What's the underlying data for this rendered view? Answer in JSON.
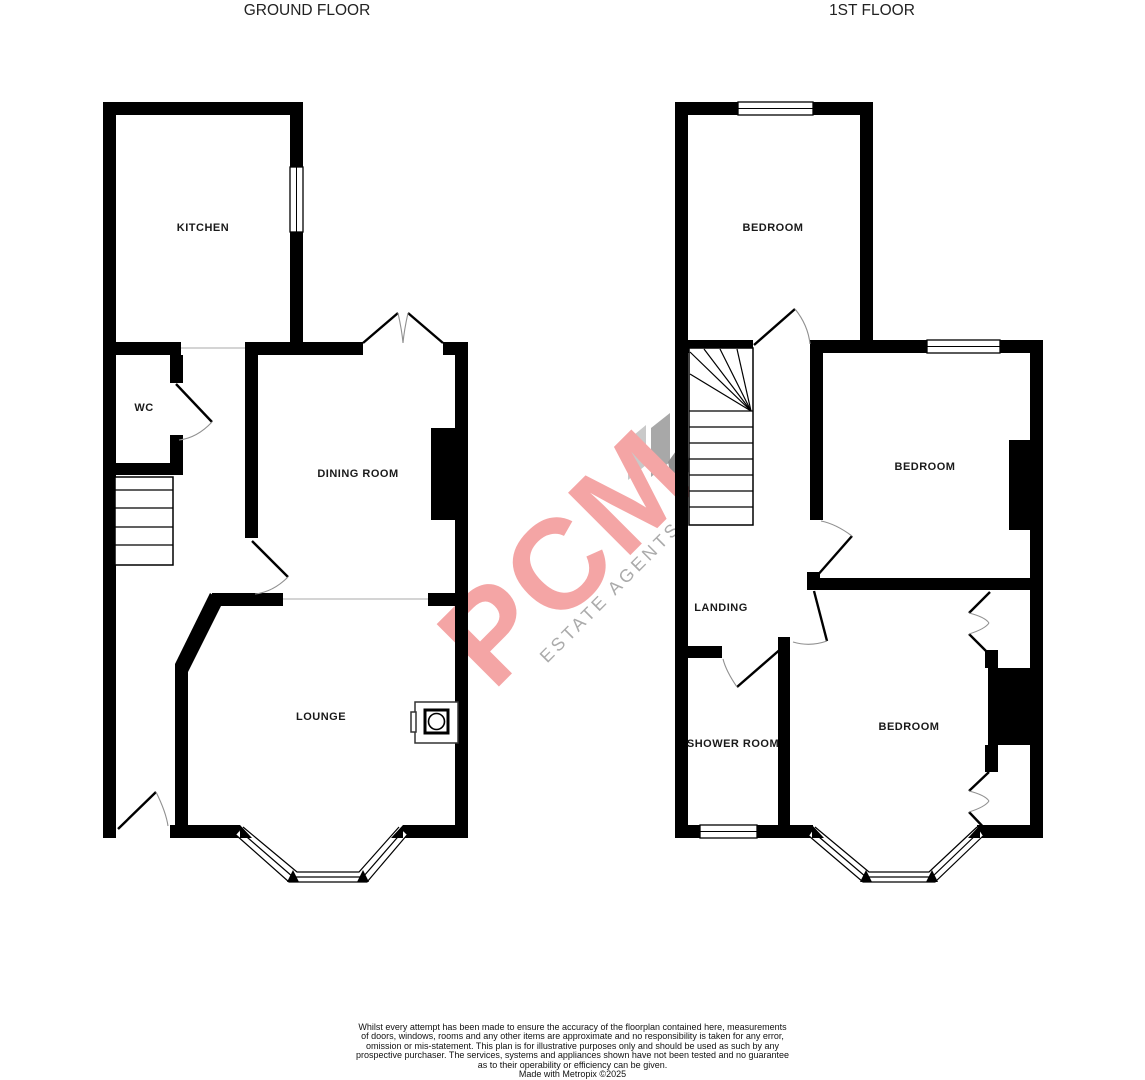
{
  "floors": {
    "ground": {
      "title": "GROUND FLOOR",
      "rooms": {
        "kitchen": "KITCHEN",
        "wc": "WC",
        "dining_room": "DINING ROOM",
        "lounge": "LOUNGE"
      }
    },
    "first": {
      "title": "1ST FLOOR",
      "rooms": {
        "bedroom_top": "BEDROOM",
        "bedroom_middle": "BEDROOM",
        "landing": "LANDING",
        "shower_room": "SHOWER ROOM",
        "bedroom_bottom": "BEDROOM"
      }
    }
  },
  "watermark": {
    "brand": "PCM",
    "tagline": "ESTATE AGENTS"
  },
  "disclaimer": {
    "lines": [
      "Whilst every attempt has been made to ensure the accuracy of the floorplan contained here, measurements",
      "of doors, windows, rooms and any other items are approximate and no responsibility is taken for any error,",
      "omission or mis-statement. This plan is for illustrative purposes only and should be used as such by any",
      "prospective purchaser. The services, systems and appliances shown have not been tested and no guarantee",
      "as to their operability or efficiency can be given.",
      "Made with Metropix ©2025"
    ]
  },
  "colors": {
    "wall": "#000000",
    "label_text": "#1a1a1a",
    "watermark_pink": "#f4a5a5",
    "watermark_gray": "#ababab"
  }
}
